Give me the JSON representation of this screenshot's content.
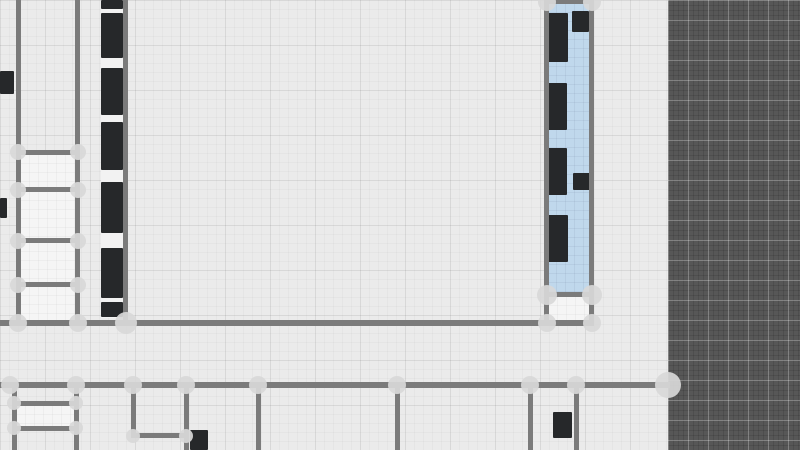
{
  "app": {
    "view": "floorplan-canvas",
    "visible_text": []
  },
  "canvas": {
    "width": 800,
    "height": 450
  },
  "colors": {
    "floor_background": "#ebebeb",
    "outside_background": "#575757",
    "wall": "#7b7b7b",
    "wall_node": "#d8d8d8",
    "furniture": "#26282a",
    "selected_room_fill": "#c0d8ec",
    "room_fill": "#f5f5f5",
    "counter_fill": "#f2f2f2"
  },
  "plan": {
    "outside_area": {
      "x": 668,
      "y": 0,
      "w": 132,
      "h": 450
    },
    "selected_room": {
      "x": 547,
      "y": 3,
      "w": 44,
      "h": 290
    },
    "counter_strip": {
      "x": 101,
      "y": 0,
      "w": 23,
      "h": 318
    },
    "rooms": [
      {
        "x": 20,
        "y": 154,
        "w": 56,
        "h": 34
      },
      {
        "x": 20,
        "y": 191,
        "w": 56,
        "h": 48
      },
      {
        "x": 20,
        "y": 242,
        "w": 56,
        "h": 41
      },
      {
        "x": 20,
        "y": 286,
        "w": 56,
        "h": 35
      },
      {
        "x": 548,
        "y": 296,
        "w": 42,
        "h": 25
      },
      {
        "x": 16,
        "y": 405,
        "w": 59,
        "h": 22
      }
    ],
    "walls": [
      {
        "x": 16,
        "y": 0,
        "w": 5,
        "h": 326
      },
      {
        "x": 75,
        "y": 0,
        "w": 5,
        "h": 326
      },
      {
        "x": 123,
        "y": 0,
        "w": 5,
        "h": 326
      },
      {
        "x": 544,
        "y": 0,
        "w": 5,
        "h": 326
      },
      {
        "x": 589,
        "y": 0,
        "w": 5,
        "h": 326
      },
      {
        "x": 544,
        "y": 0,
        "w": 50,
        "h": 4
      },
      {
        "x": 16,
        "y": 150,
        "w": 64,
        "h": 5
      },
      {
        "x": 16,
        "y": 187,
        "w": 64,
        "h": 5
      },
      {
        "x": 16,
        "y": 238,
        "w": 64,
        "h": 5
      },
      {
        "x": 16,
        "y": 282,
        "w": 64,
        "h": 5
      },
      {
        "x": 544,
        "y": 292,
        "w": 50,
        "h": 5
      },
      {
        "x": 0,
        "y": 320,
        "w": 594,
        "h": 6
      },
      {
        "x": 0,
        "y": 382,
        "w": 670,
        "h": 6
      },
      {
        "x": 12,
        "y": 388,
        "w": 5,
        "h": 62
      },
      {
        "x": 74,
        "y": 388,
        "w": 5,
        "h": 62
      },
      {
        "x": 131,
        "y": 388,
        "w": 5,
        "h": 50
      },
      {
        "x": 184,
        "y": 388,
        "w": 5,
        "h": 62
      },
      {
        "x": 256,
        "y": 388,
        "w": 5,
        "h": 62
      },
      {
        "x": 395,
        "y": 388,
        "w": 5,
        "h": 62
      },
      {
        "x": 528,
        "y": 388,
        "w": 5,
        "h": 62
      },
      {
        "x": 574,
        "y": 388,
        "w": 5,
        "h": 62
      },
      {
        "x": 12,
        "y": 401,
        "w": 67,
        "h": 5
      },
      {
        "x": 12,
        "y": 426,
        "w": 67,
        "h": 5
      },
      {
        "x": 131,
        "y": 433,
        "w": 58,
        "h": 5
      }
    ],
    "nodes": [
      {
        "x": 18,
        "y": 152,
        "r": 8
      },
      {
        "x": 78,
        "y": 152,
        "r": 8
      },
      {
        "x": 18,
        "y": 190,
        "r": 8
      },
      {
        "x": 78,
        "y": 190,
        "r": 8
      },
      {
        "x": 18,
        "y": 241,
        "r": 8
      },
      {
        "x": 78,
        "y": 241,
        "r": 8
      },
      {
        "x": 18,
        "y": 285,
        "r": 8
      },
      {
        "x": 78,
        "y": 285,
        "r": 8
      },
      {
        "x": 18,
        "y": 323,
        "r": 9
      },
      {
        "x": 78,
        "y": 323,
        "r": 9
      },
      {
        "x": 126,
        "y": 323,
        "r": 11
      },
      {
        "x": 547,
        "y": 2,
        "r": 9
      },
      {
        "x": 592,
        "y": 2,
        "r": 9
      },
      {
        "x": 547,
        "y": 295,
        "r": 10
      },
      {
        "x": 592,
        "y": 295,
        "r": 10
      },
      {
        "x": 547,
        "y": 323,
        "r": 9
      },
      {
        "x": 592,
        "y": 323,
        "r": 9
      },
      {
        "x": 10,
        "y": 385,
        "r": 9
      },
      {
        "x": 76,
        "y": 385,
        "r": 9
      },
      {
        "x": 133,
        "y": 385,
        "r": 9
      },
      {
        "x": 186,
        "y": 385,
        "r": 9
      },
      {
        "x": 258,
        "y": 385,
        "r": 9
      },
      {
        "x": 397,
        "y": 385,
        "r": 9
      },
      {
        "x": 530,
        "y": 385,
        "r": 9
      },
      {
        "x": 576,
        "y": 385,
        "r": 9
      },
      {
        "x": 668,
        "y": 385,
        "r": 13
      },
      {
        "x": 14,
        "y": 403,
        "r": 7
      },
      {
        "x": 76,
        "y": 403,
        "r": 7
      },
      {
        "x": 14,
        "y": 428,
        "r": 7
      },
      {
        "x": 76,
        "y": 428,
        "r": 7
      },
      {
        "x": 133,
        "y": 436,
        "r": 7
      },
      {
        "x": 186,
        "y": 436,
        "r": 7
      }
    ],
    "furniture": [
      {
        "x": 101,
        "y": 0,
        "w": 22,
        "h": 9
      },
      {
        "x": 101,
        "y": 13,
        "w": 22,
        "h": 45
      },
      {
        "x": 101,
        "y": 68,
        "w": 22,
        "h": 47
      },
      {
        "x": 101,
        "y": 122,
        "w": 22,
        "h": 48
      },
      {
        "x": 101,
        "y": 182,
        "w": 22,
        "h": 51
      },
      {
        "x": 101,
        "y": 248,
        "w": 22,
        "h": 50
      },
      {
        "x": 101,
        "y": 302,
        "w": 22,
        "h": 15
      },
      {
        "x": 0,
        "y": 71,
        "w": 14,
        "h": 23
      },
      {
        "x": 0,
        "y": 198,
        "w": 7,
        "h": 20
      },
      {
        "x": 548,
        "y": 13,
        "w": 20,
        "h": 49
      },
      {
        "x": 572,
        "y": 11,
        "w": 17,
        "h": 21
      },
      {
        "x": 548,
        "y": 83,
        "w": 19,
        "h": 47
      },
      {
        "x": 548,
        "y": 148,
        "w": 19,
        "h": 47
      },
      {
        "x": 573,
        "y": 173,
        "w": 17,
        "h": 17
      },
      {
        "x": 548,
        "y": 215,
        "w": 20,
        "h": 47
      },
      {
        "x": 190,
        "y": 430,
        "w": 18,
        "h": 20
      },
      {
        "x": 553,
        "y": 412,
        "w": 19,
        "h": 26
      }
    ]
  }
}
